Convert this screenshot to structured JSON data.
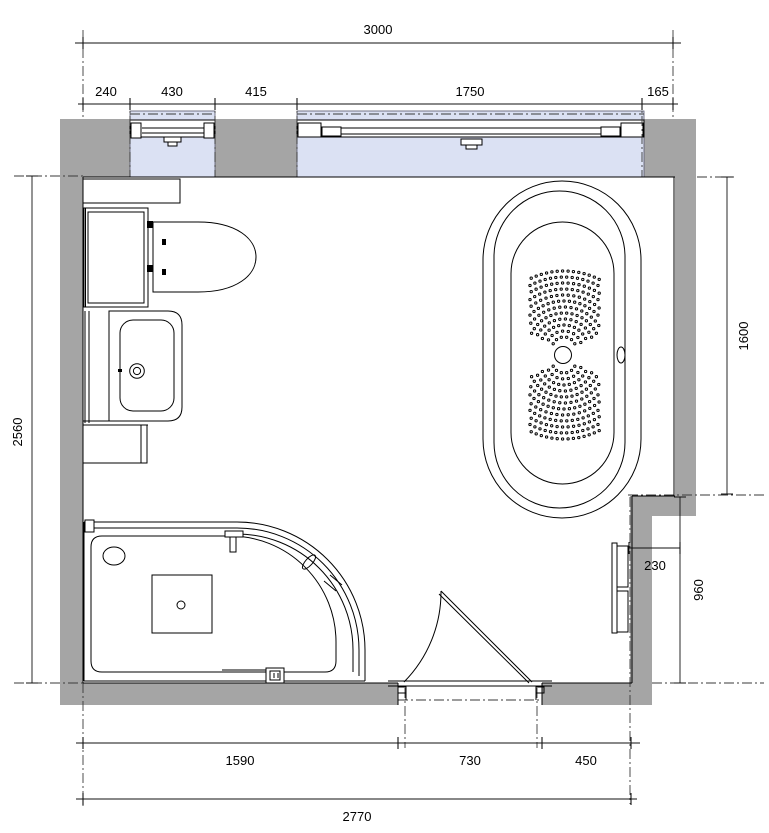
{
  "floor_plan": {
    "dimensions": {
      "top_overall": "3000",
      "top_chain": [
        "240",
        "430",
        "415",
        "1750",
        "165"
      ],
      "left_overall": "2560",
      "right_upper": "1600",
      "step_depth": "230",
      "right_lower": "960",
      "bottom_chain": [
        "1590",
        "730",
        "450"
      ],
      "bottom_overall": "2770"
    },
    "colors": {
      "wall": "#a5a5a5",
      "glazing": "#dbe1f3",
      "line": "#000000"
    },
    "fixtures": [
      "window",
      "window",
      "toilet",
      "cistern-cabinet",
      "wall-shelf",
      "washbasin-vanity",
      "base-cabinet",
      "corner-shower",
      "whirlpool-bathtub",
      "door",
      "radiator"
    ]
  }
}
